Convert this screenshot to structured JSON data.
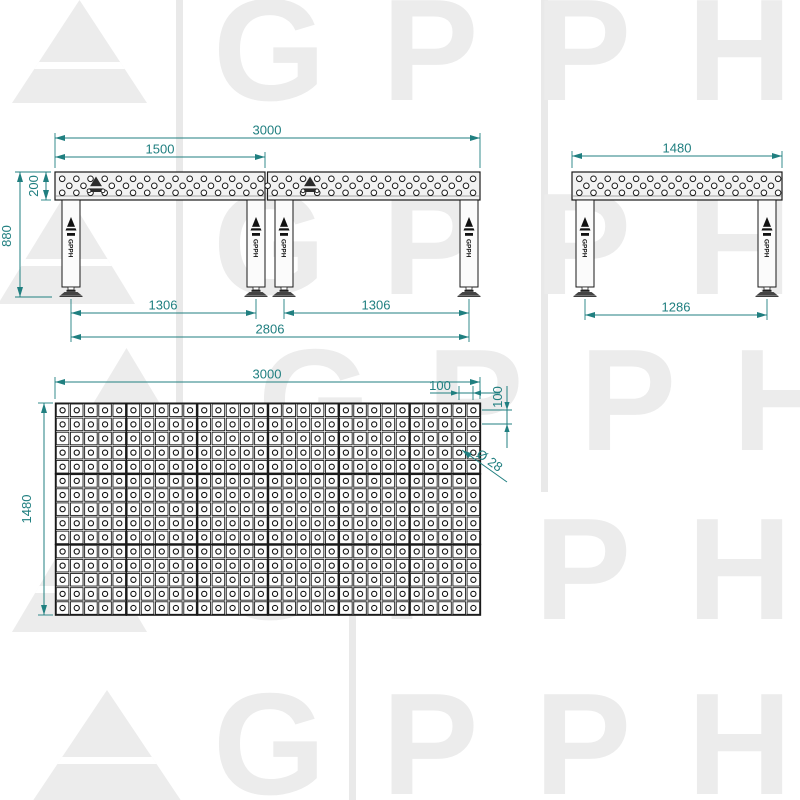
{
  "watermark": {
    "brand": "GPPH"
  },
  "colors": {
    "dimension": "#207f80",
    "line": "#1a1a1a",
    "watermark": "#ececec",
    "top_fill": "#f2f2f2"
  },
  "legs": {
    "logo_text": "GPPH"
  },
  "views": {
    "front": {
      "dims": {
        "overall_width": "3000",
        "half_width": "1500",
        "top_height": "200",
        "total_height": "880",
        "leg_span_left": "1306",
        "leg_span_right": "1306",
        "outer_leg_span": "2806"
      }
    },
    "side": {
      "dims": {
        "width": "1480",
        "leg_span": "1286"
      }
    },
    "plan": {
      "grid": {
        "cols": 30,
        "rows": 15
      },
      "dims": {
        "width": "3000",
        "depth": "1480",
        "hole_pitch_x": "100",
        "hole_pitch_y": "100",
        "hole_diameter": "Ø 28"
      }
    }
  }
}
